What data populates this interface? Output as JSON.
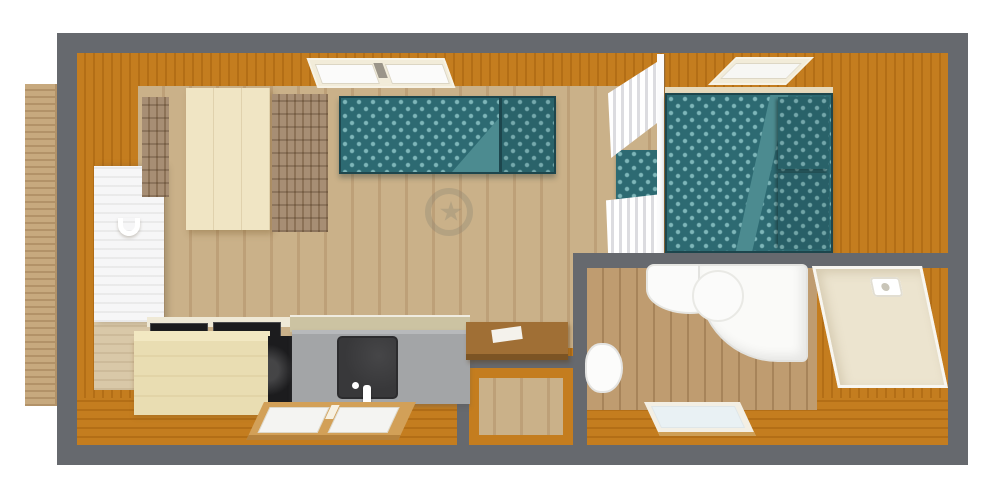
{
  "scene": {
    "type": "floor-plan",
    "description": "Top-down 3D rendered floor plan of a small cabin / mobile home",
    "rooms": [
      {
        "name": "living-kitchen-area"
      },
      {
        "name": "bedroom"
      },
      {
        "name": "bathroom"
      },
      {
        "name": "entry"
      },
      {
        "name": "deck"
      }
    ],
    "furniture": [
      {
        "name": "dining-table"
      },
      {
        "name": "chair-left"
      },
      {
        "name": "chair-right"
      },
      {
        "name": "daybed-sofa"
      },
      {
        "name": "double-bed"
      },
      {
        "name": "pillows"
      },
      {
        "name": "curtain-partition"
      },
      {
        "name": "kitchen-cabinet"
      },
      {
        "name": "cooktop"
      },
      {
        "name": "oven"
      },
      {
        "name": "kitchen-counter"
      },
      {
        "name": "kitchen-sink"
      },
      {
        "name": "desk"
      },
      {
        "name": "bathroom-sink"
      },
      {
        "name": "shower-tray"
      },
      {
        "name": "shower-enclosure"
      },
      {
        "name": "toilet"
      },
      {
        "name": "entry-door"
      },
      {
        "name": "window-living"
      },
      {
        "name": "window-bedroom"
      },
      {
        "name": "window-kitchen"
      },
      {
        "name": "window-bathroom"
      },
      {
        "name": "watermark-logo"
      }
    ]
  },
  "colors": {
    "wall": "#66696e",
    "floor_orange": "#c47d1f",
    "floor_orange_dark": "#b36e16",
    "floor_light": "#cab189",
    "floor_light_dark": "#bda078",
    "floor_bath": "#bf9c70",
    "floor_bath_dark": "#a7845a",
    "deck": "#c7a97e",
    "deck_dark": "#b29268",
    "table": "#f0e5c4",
    "chair_wood": "#a78e74",
    "chair_wood_dark": "#8c7257",
    "teal": "#2d6a72",
    "teal_dot": "#7fb7ba",
    "teal_fold": "#4c8b90",
    "teal_dark": "#1d464d",
    "white_soft": "#f6f6f7",
    "curtain_shade": "#dcdce0",
    "counter": "#a3a5a7",
    "cabinet": "#e9ddb2",
    "backsplash": "#ccc3a2",
    "appliance_dark": "#1c1c1e",
    "sink_dark": "#38383a",
    "desk_wood": "#a06f35",
    "desk_wood_dark": "#7c5424",
    "window_wood": "#d2a058",
    "shower_beige": "#ece4cf",
    "pane_blue": "#e9f1f4",
    "watermark": "#8a8472"
  }
}
